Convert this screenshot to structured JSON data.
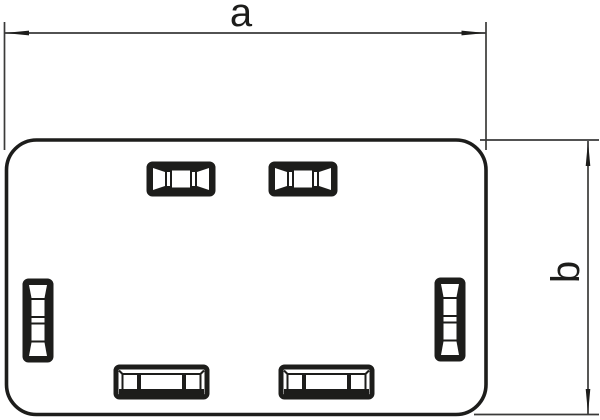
{
  "drawing": {
    "dimension_labels": {
      "a": "a",
      "b": "b"
    },
    "colors": {
      "outline": "#1d1d1b",
      "dimension_line": "#3a3a39",
      "background": "#ffffff"
    },
    "component": {
      "slots_top_count": 2,
      "slots_bottom_count": 2,
      "slots_side_count": 2
    }
  }
}
